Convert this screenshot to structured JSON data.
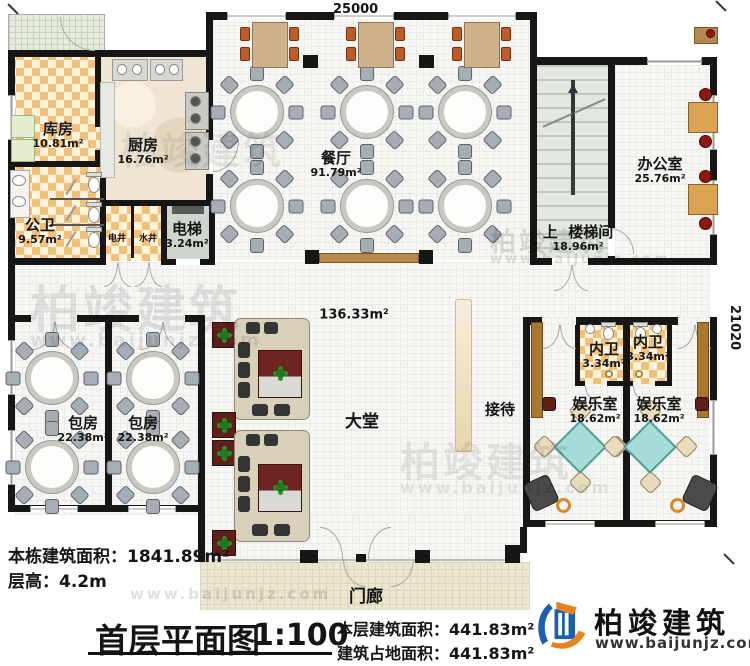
{
  "dimensions": {
    "top": "25000",
    "right": "21020"
  },
  "rooms": {
    "storage": {
      "name": "库房",
      "area": "10.81m²"
    },
    "kitchen": {
      "name": "厨房",
      "area": "16.76m²"
    },
    "public_wc": {
      "name": "公卫",
      "area": "9.57m²"
    },
    "electric_shaft": {
      "name": "电井"
    },
    "water_shaft": {
      "name": "水井"
    },
    "elevator": {
      "name": "电梯",
      "area": "3.24m²"
    },
    "dining": {
      "name": "餐厅",
      "area": "91.79m²"
    },
    "stair": {
      "up": "上",
      "name": "楼梯间",
      "area": "18.96m²"
    },
    "office": {
      "name": "办公室",
      "area": "25.76m²"
    },
    "lobby": {
      "name": "大堂",
      "area": "136.33m²"
    },
    "reception": {
      "name": "接待"
    },
    "private_room_1": {
      "name": "包房",
      "area": "22.38m²"
    },
    "private_room_2": {
      "name": "包房",
      "area": "22.38m²"
    },
    "inner_wc_1": {
      "name": "内卫",
      "area": "3.34m²"
    },
    "inner_wc_2": {
      "name": "内卫",
      "area": "3.34m²"
    },
    "entertainment_1": {
      "name": "娱乐室",
      "area": "18.62m²"
    },
    "entertainment_2": {
      "name": "娱乐室",
      "area": "18.62m²"
    },
    "porch": {
      "name": "门廊"
    }
  },
  "stats": {
    "building_total_label": "本栋建筑面积：",
    "building_total_value": "1841.89m²",
    "floor_height_label": "层高：",
    "floor_height_value": "4.2m",
    "floor_area_label": "本层建筑面积：",
    "floor_area_value": "441.83m²",
    "footprint_label": "建筑占地面积：",
    "footprint_value": "441.83m²"
  },
  "title": {
    "text": "首层平面图",
    "scale": "1:100"
  },
  "brand": {
    "name": "柏竣建筑",
    "url": "www.baijunjz.com",
    "blue": "#1b5fae",
    "orange": "#e8821e"
  },
  "watermark": {
    "text": "柏竣建筑",
    "url": "www.baijunjz.com"
  }
}
